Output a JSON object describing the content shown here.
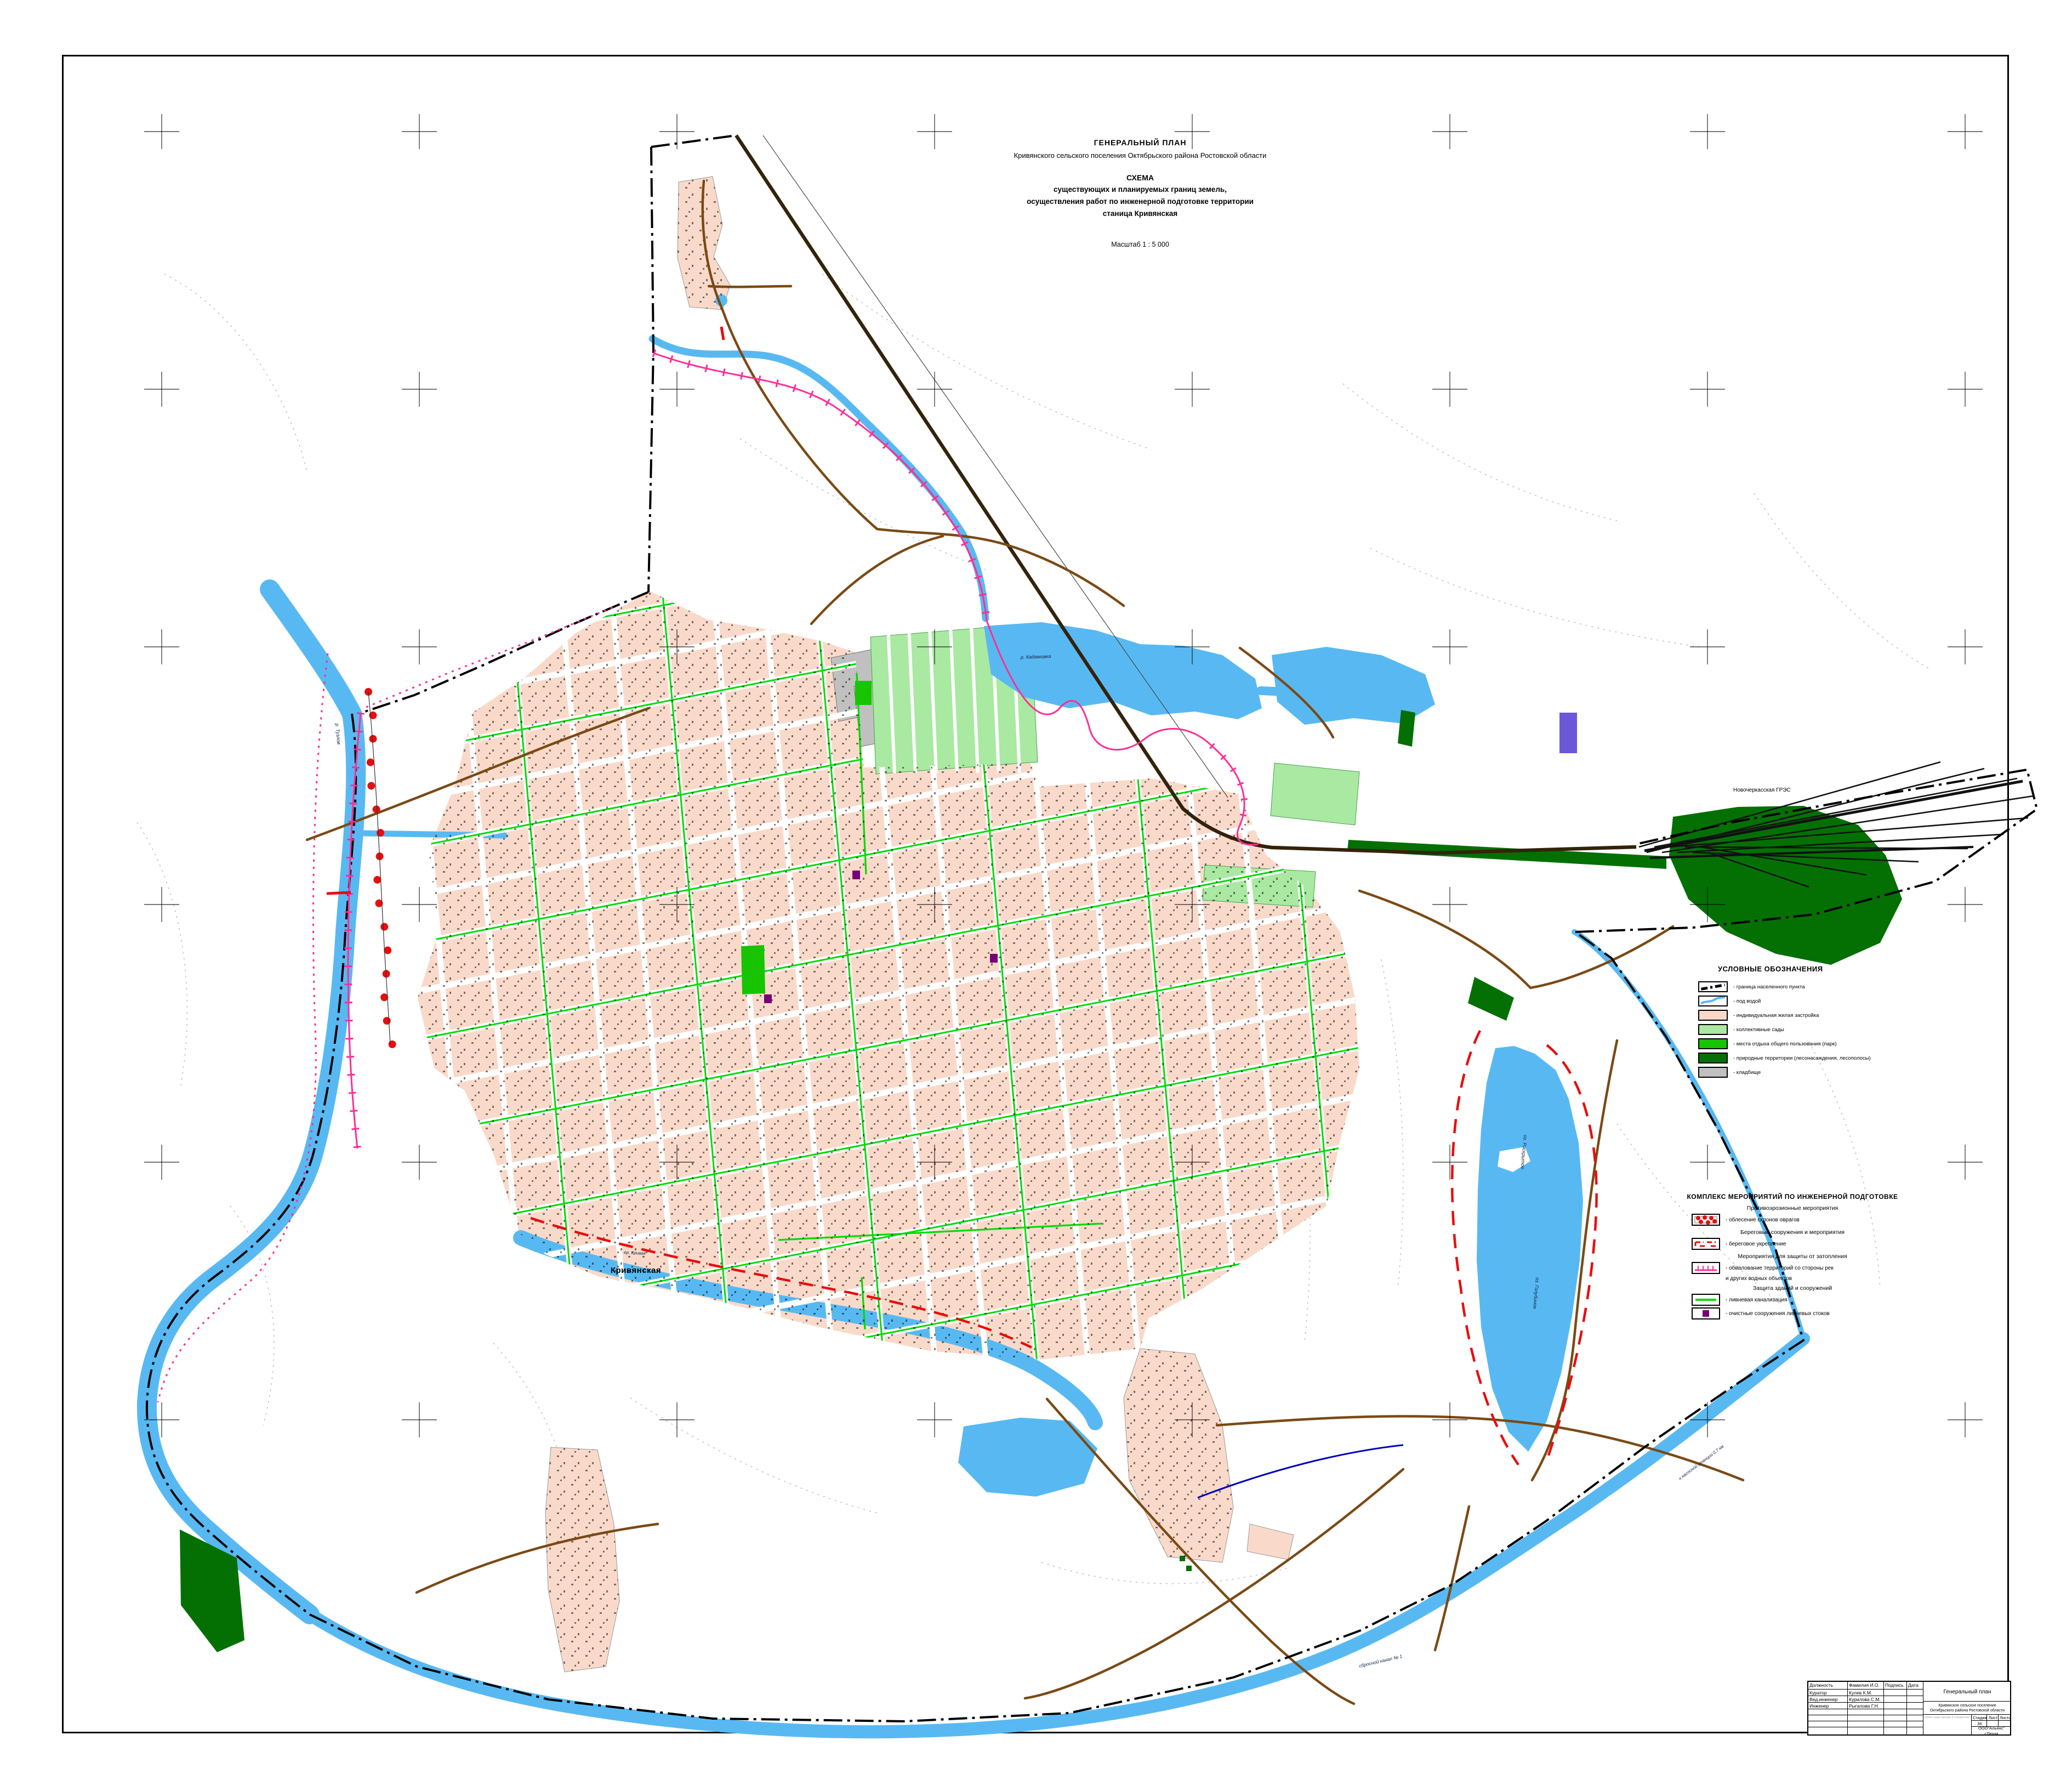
{
  "title_block": {
    "line1": "ГЕНЕРАЛЬНЫЙ  ПЛАН",
    "line2": "Кривянского сельского поселения  Октябрьского  района  Ростовской области",
    "line3": "СХЕМА",
    "line4": "существующих и планируемых границ земель,",
    "line5": "осуществления работ по инженерной подготовке территории",
    "line6": "станица  Кривянская",
    "scale": "Масштаб 1 : 5 000"
  },
  "map_labels": {
    "town": "Кривянская",
    "power_station": "Новочеркасская ГРЭС",
    "river_tuzlov": "р. Тузлов",
    "river_kadamovka": "р. Кадамовка",
    "river_krivaya": "ер. Кривая",
    "lake_raskrytoe": "оз. Раскрытое",
    "lake_golubinoe": "оз. Голубиное",
    "canal": "сбросной канал № 1",
    "pump_station": "к насосной станции 0,7 км"
  },
  "legend_symbols": {
    "title": "УСЛОВНЫЕ ОБОЗНАЧЕНИЯ",
    "items": [
      {
        "label": "- граница населенного пункта",
        "symbol": "boundary-dash-dot-line",
        "color": "#000000"
      },
      {
        "label": "- под  водой",
        "symbol": "water-line",
        "color": "#58B9F2"
      },
      {
        "label": "-  индивидуальная жилая застройка",
        "symbol": "area-fill",
        "color": "#F9DACA"
      },
      {
        "label": "-  коллективные сады",
        "symbol": "area-fill",
        "color": "#A9E9A1"
      },
      {
        "label": "- места отдыха общего пользования (парк)",
        "symbol": "area-fill",
        "color": "#17C400"
      },
      {
        "label": "- природные территории (лесонасаждения, лесополосы)",
        "symbol": "area-fill",
        "color": "#047004"
      },
      {
        "label": "- кладбище",
        "symbol": "area-fill",
        "color": "#C0C0C0"
      }
    ]
  },
  "legend_measures": {
    "title": "КОМПЛЕКС  МЕРОПРИЯТИЙ ПО ИНЖЕНЕРНОЙ ПОДГОТОВКЕ",
    "h1": "Противоэрозионные  мероприятия",
    "i1": "- облесение склонов оврагов",
    "h2": "Береговые сооружения и мероприятия",
    "i2": "- береговое укрепление",
    "h3": "Мероприятия для защиты от затопления",
    "i3a": "- обвалование территорий со стороны рек",
    "i3b": "и других водных объектов",
    "h4": "Защита зданий и сооружений",
    "i4": "- ливневая канализация",
    "i5": "- очистные сооружения ливневых стоков"
  },
  "stamp": {
    "col_role": "Должность",
    "col_name": "Фамилия И.О.",
    "col_sign": "Подпись",
    "col_date": "Дата",
    "rows": [
      {
        "role": "Куратор",
        "name": "Кулев  К.М."
      },
      {
        "role": "Вед.инженер",
        "name": "Курилова С.М."
      },
      {
        "role": "Инженер",
        "name": "Рыгалова Г.Н."
      }
    ],
    "doc_title": "Генеральный план",
    "doc_subtitle1": "Кривянское сельское поселение",
    "doc_subtitle2": "Октябрьского района  Ростовской области",
    "scheme_note": "СХЕМА существующих и планируемых границ земель, осуществления работ по инженерной подготовке территории станица Кривянская Масштаб 1:5000",
    "stage_label": "Стадия",
    "sheet_label": "Лист",
    "sheets_label": "Листов",
    "stage_value": "ЗК",
    "company": "ООО\"Альянс\"",
    "city": "г.Пенза"
  },
  "colors": {
    "water": "#58B9F2",
    "housing": "#F9DACA",
    "gardens": "#A9E9A1",
    "park": "#17C400",
    "forest": "#047004",
    "cemetery": "#C0C0C0",
    "embankment": "#FF2D96",
    "bank_protection": "#E80E0E",
    "storm_sewer": "#00DC00",
    "treatment": "#760076",
    "road": "#7A4A15",
    "railway": "#33230B",
    "boundary": "#000000"
  }
}
